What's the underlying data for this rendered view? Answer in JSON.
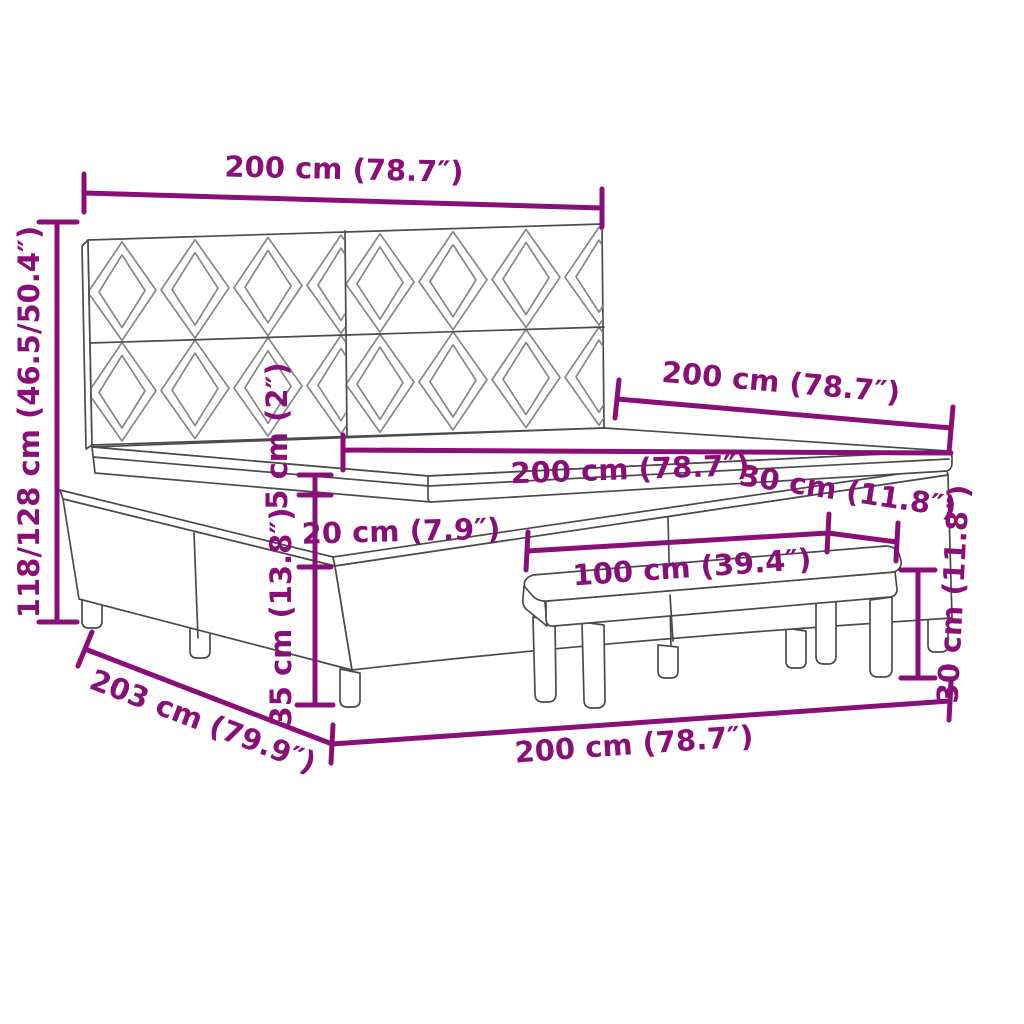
{
  "diagram": {
    "kind": "product-dimension-diagram",
    "subject": "boxspring bed with patterned headboard and bench",
    "colors": {
      "accent": "#8A0E78",
      "outline": "#4B4B4B",
      "pattern": "#878787",
      "background": "#FFFFFF"
    },
    "labels": {
      "headboard_width": "200 cm (78.7″)",
      "total_height": "118/128 cm (46.5/50.4″)",
      "bed_length_top": "200 cm (78.7″)",
      "mattress_width": "200 cm (78.7″)",
      "bench_depth": "30 cm (11.8″)",
      "bench_length": "100 cm (39.4″)",
      "topper_thickness": "5 cm (2″)",
      "mattress_thickness": "20 cm (7.9″)",
      "base_height": "35 cm (13.8″)",
      "bench_height": "30 cm (11.8″)",
      "bed_length_floor": "203 cm (79.9″)",
      "bed_width_front": "200 cm (78.7″)"
    }
  }
}
